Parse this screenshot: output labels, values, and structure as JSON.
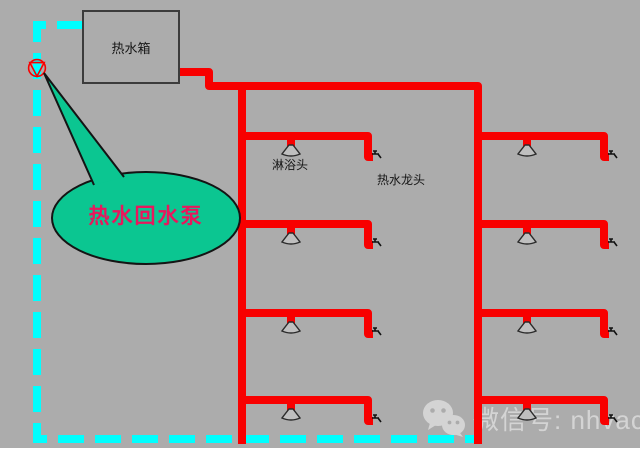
{
  "colors": {
    "bg": "#ACACAC",
    "red": "#F80000",
    "cyan": "#00FFFF",
    "green": "#0BC691",
    "pink": "#E8175D",
    "ink": "#3C3C3C",
    "watermark": "#DCDCDC"
  },
  "tank": {
    "label": "热水箱"
  },
  "callout": {
    "label": "热水回水泵"
  },
  "annotations": {
    "shower_label": "淋浴头",
    "faucet_label": "热水龙头"
  },
  "watermark": {
    "text": "微信号: nhvaca"
  },
  "icons": {
    "pump": "pump-icon",
    "shower": "shower-head-icon",
    "faucet": "faucet-icon",
    "wechat": "wechat-icon"
  }
}
